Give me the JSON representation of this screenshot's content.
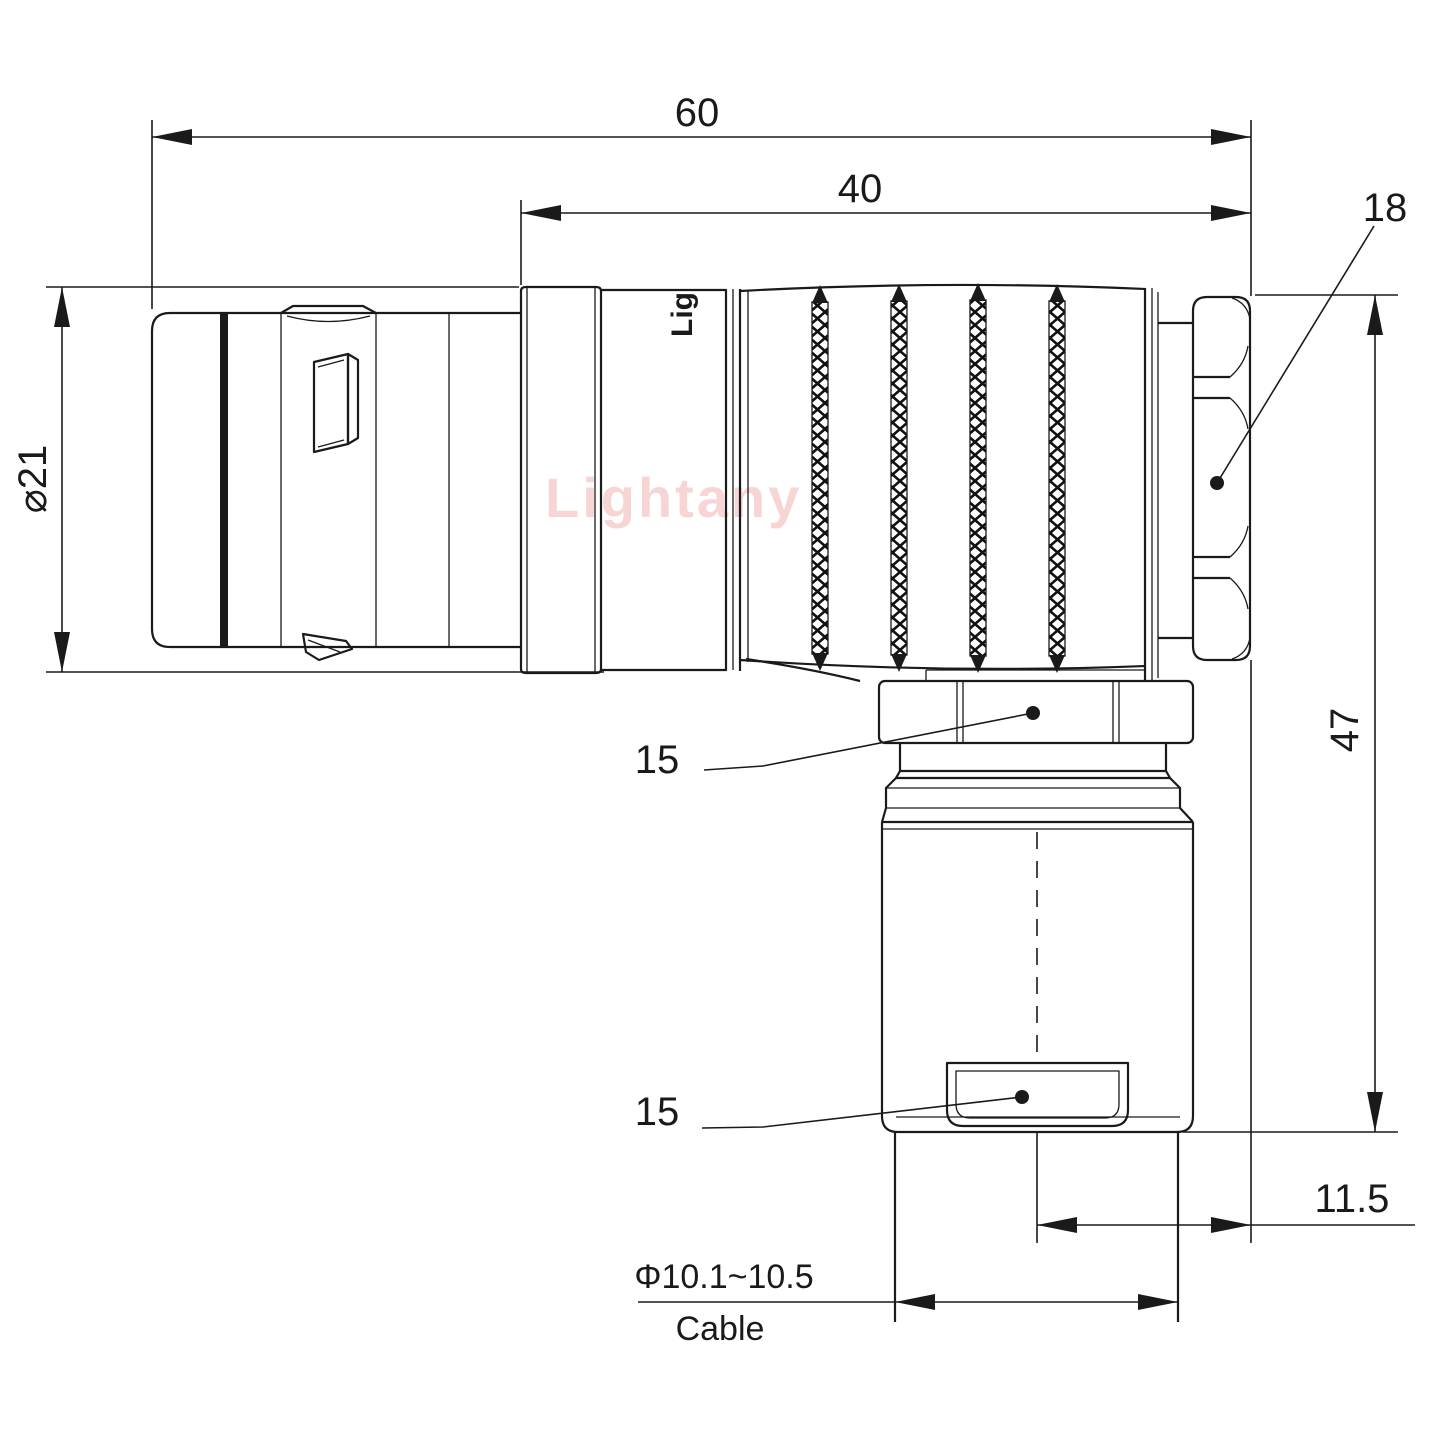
{
  "drawing": {
    "watermark": "Lightany",
    "body_logo": "Lig",
    "colors": {
      "line": "#1a1a1a",
      "watermark": "#f5c8c8"
    },
    "dimensions": {
      "overall_length": "60",
      "grip_length": "40",
      "rear_nut_size": "18",
      "shell_diameter": "⌀21",
      "height": "47",
      "coupling_nut_size": "15",
      "cable_clamp_size": "15",
      "axis_offset": "11.5",
      "cable_diameter_range": "Φ10.1~10.5",
      "cable_label": "Cable"
    }
  }
}
